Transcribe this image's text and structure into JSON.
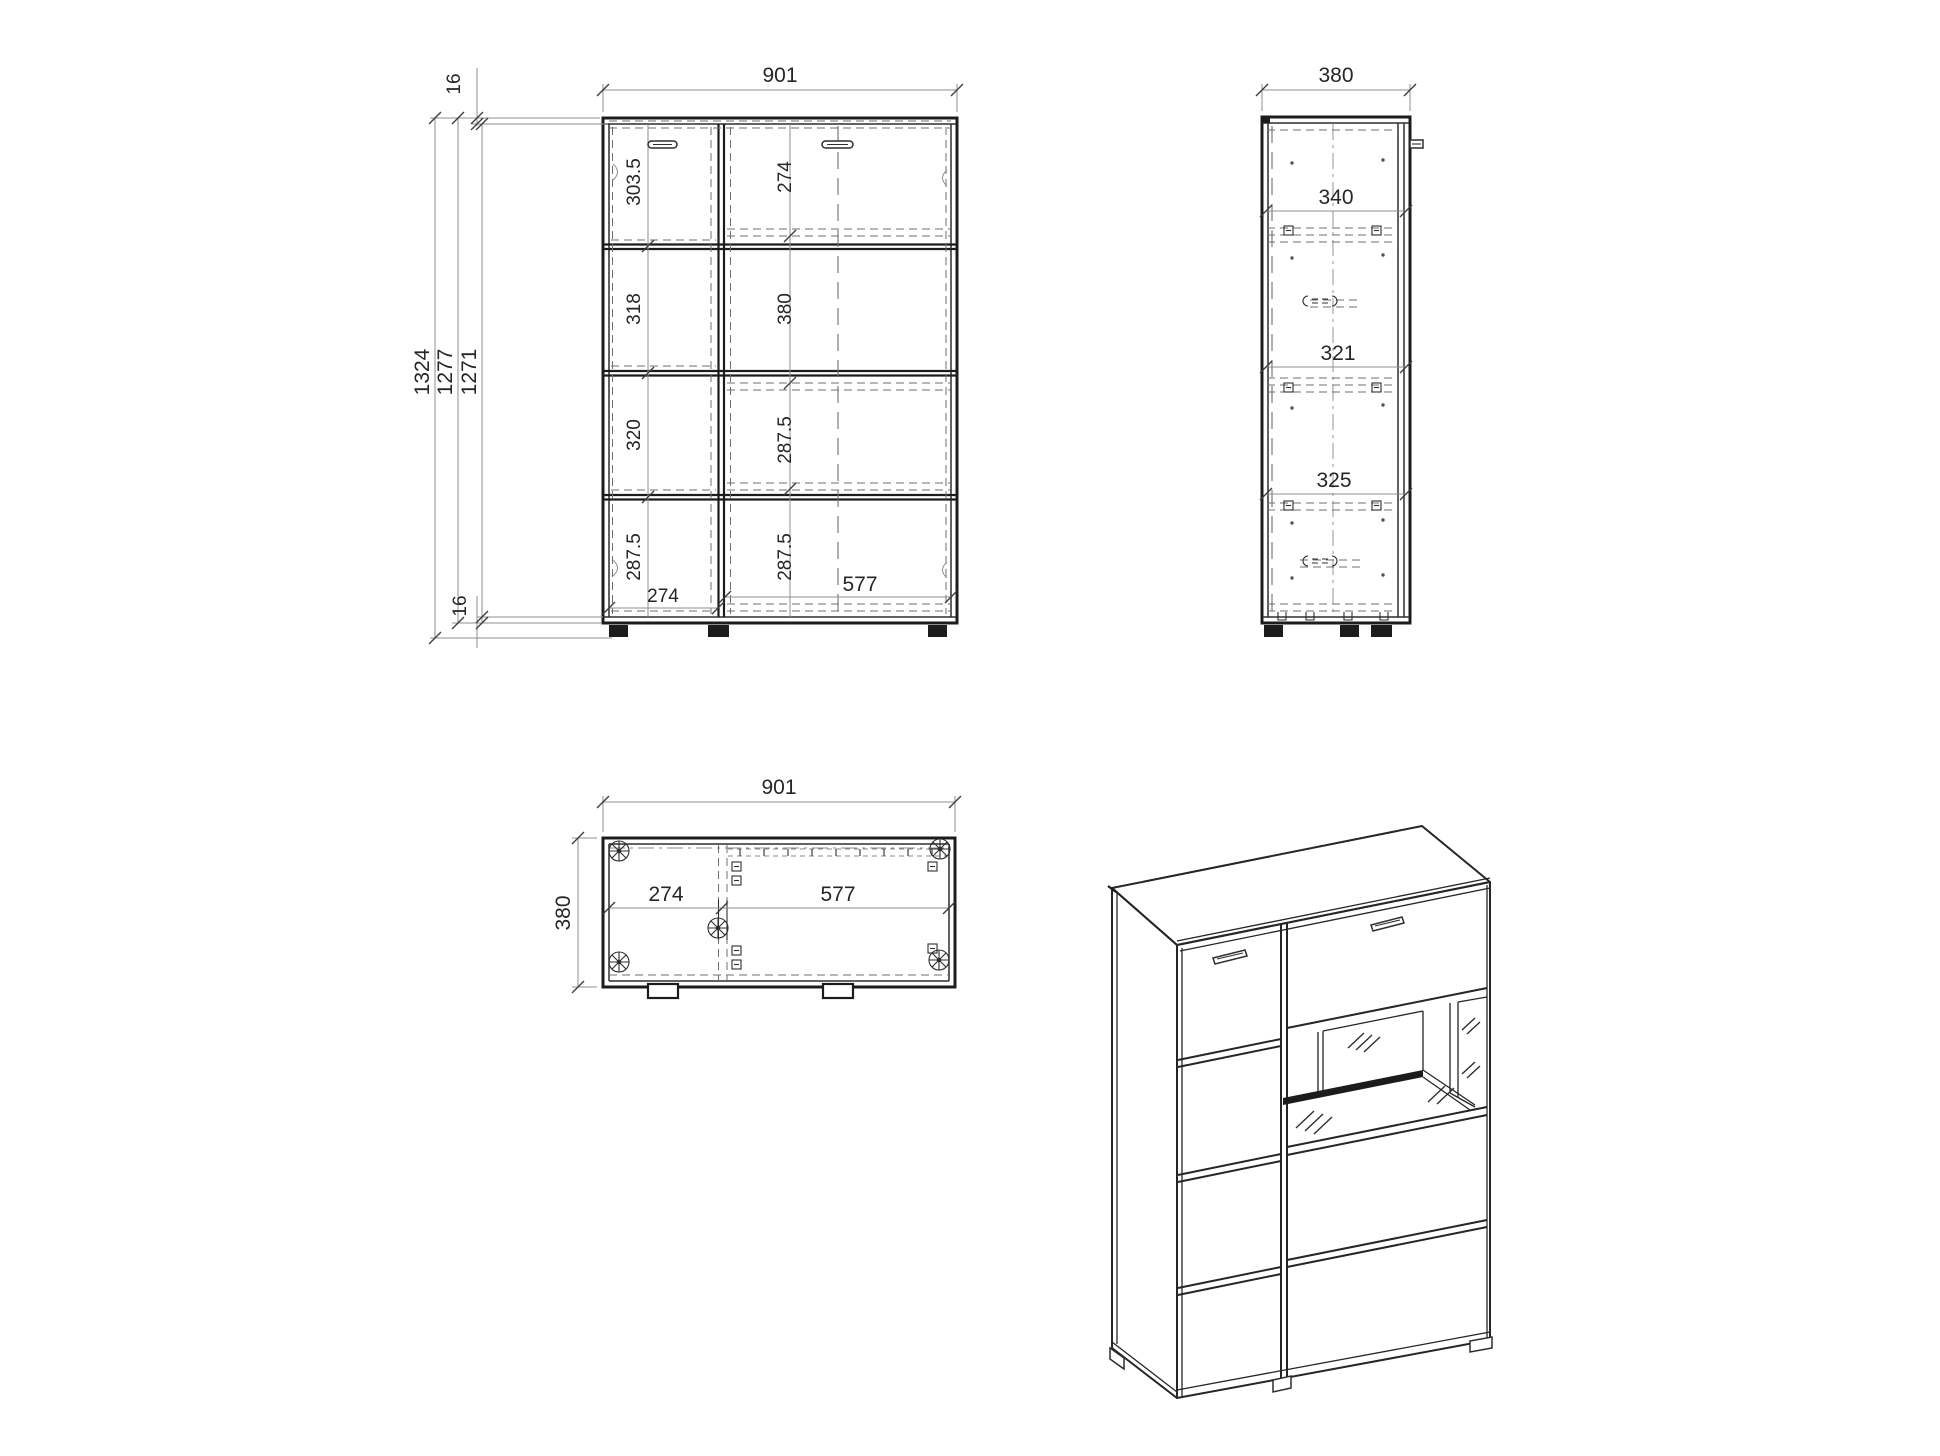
{
  "drawing": {
    "type": "furniture cabinet technical drawing with four views",
    "colors": {
      "background": "#ffffff",
      "line": "#1c1c1c",
      "dim_text": "#262626"
    },
    "front": {
      "width": "901",
      "top_thickness": "16",
      "heights": [
        "1324",
        "1277",
        "1271"
      ],
      "bottom_thickness": "16",
      "left_sections": [
        "303.5",
        "318",
        "320",
        "287.5"
      ],
      "right_sections": [
        "274",
        "380",
        "287.5",
        "287.5"
      ],
      "bottom_widths": [
        "274",
        "577"
      ]
    },
    "side": {
      "depth": "380",
      "sections": [
        "340",
        "321",
        "325"
      ]
    },
    "top": {
      "width": "901",
      "depth": "380",
      "inner_widths": [
        "274",
        "577"
      ]
    }
  }
}
